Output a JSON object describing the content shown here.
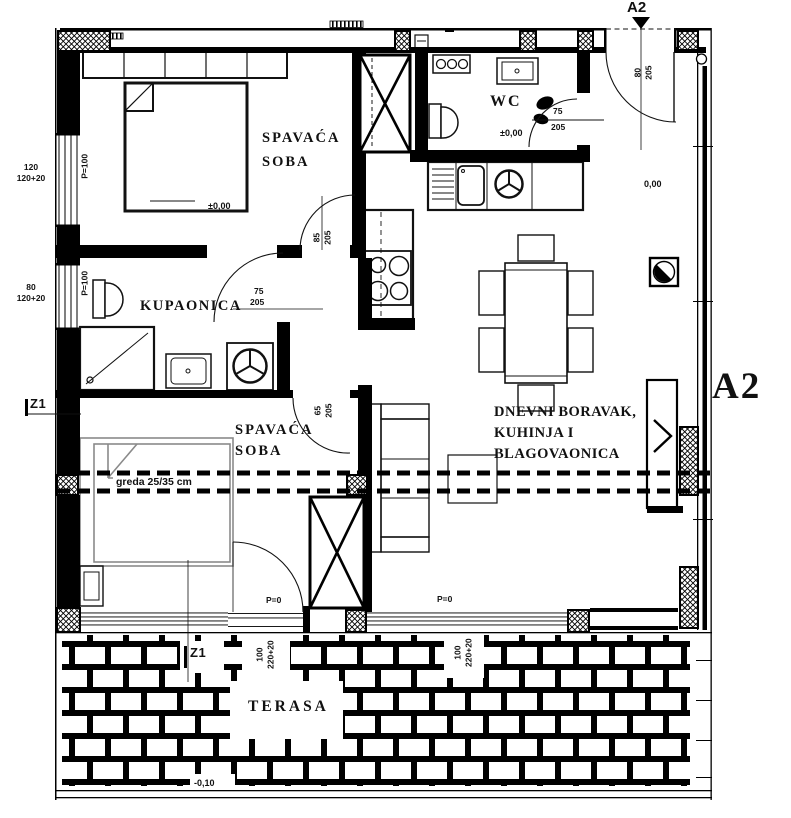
{
  "plan": {
    "marker_top": "A2",
    "marker_side": "A2",
    "rooms": {
      "bedroom1": {
        "name_line1": "SPAVAĆA",
        "name_line2": "SOBA",
        "level": "±0,00"
      },
      "wc": {
        "name": "WC",
        "level": "±0,00"
      },
      "bathroom": {
        "name": "KUPAONICA"
      },
      "bedroom2": {
        "name_line1": "SPAVAĆA",
        "name_line2": "SOBA"
      },
      "living": {
        "name_line1": "DNEVNI BORAVAK,",
        "name_line2": "KUHINJA I",
        "name_line3": "BLAGOVAONICA",
        "level": "0,00"
      },
      "terrace": {
        "name": "TERASA",
        "level": "-0,10"
      }
    },
    "annotations": {
      "beam": "greda 25/35 cm",
      "section_z1": "Z1",
      "parapet_zero": "P=0",
      "parapet_100": "P=100"
    },
    "dimensions": {
      "window_left_1": {
        "width": "120",
        "height": "120+20"
      },
      "window_left_2": {
        "width": "80",
        "height": "120+20"
      },
      "entry_door": {
        "width": "80",
        "height": "205"
      },
      "wc_door": {
        "width": "75",
        "height": "205"
      },
      "bathroom_door": {
        "width": "75",
        "height": "205"
      },
      "bedroom1_door": {
        "width": "85",
        "height": "205"
      },
      "bedroom2_door": {
        "width": "65",
        "height": "205"
      },
      "balcony_door": {
        "width": "100",
        "height": "220+20"
      },
      "living_window": {
        "width": "100",
        "height": "220+20"
      }
    }
  }
}
